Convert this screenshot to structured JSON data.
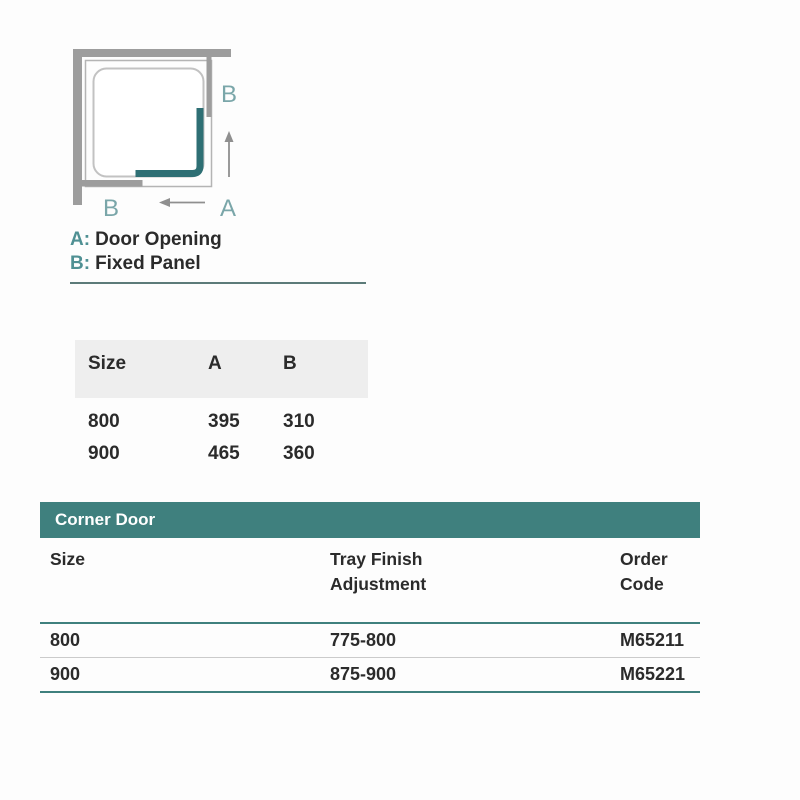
{
  "diagram": {
    "label_b_top": "B",
    "label_a_bottom": "A",
    "label_b_bottom": "B",
    "legend": [
      {
        "prefix": "A:",
        "text": "Door Opening"
      },
      {
        "prefix": "B:",
        "text": "Fixed Panel"
      }
    ]
  },
  "size_table": {
    "columns": [
      "Size",
      "A",
      "B"
    ],
    "rows": [
      [
        "800",
        "395",
        "310"
      ],
      [
        "900",
        "465",
        "360"
      ]
    ]
  },
  "order_table": {
    "title": "Corner Door",
    "columns": [
      {
        "lines": [
          "Size",
          ""
        ]
      },
      {
        "lines": [
          "Tray Finish",
          "Adjustment"
        ]
      },
      {
        "lines": [
          "Order",
          "Code"
        ]
      }
    ],
    "rows": [
      [
        "800",
        "775-800",
        "M65211"
      ],
      [
        "900",
        "875-900",
        "M65221"
      ]
    ]
  },
  "colors": {
    "accent_teal": "#3f807e",
    "door_teal": "#2e6f74",
    "label_teal": "#7aa6a9",
    "wall_gray": "#9d9d9d",
    "header_bg": "#eeeeee",
    "text_dark": "#2b2b2b"
  }
}
